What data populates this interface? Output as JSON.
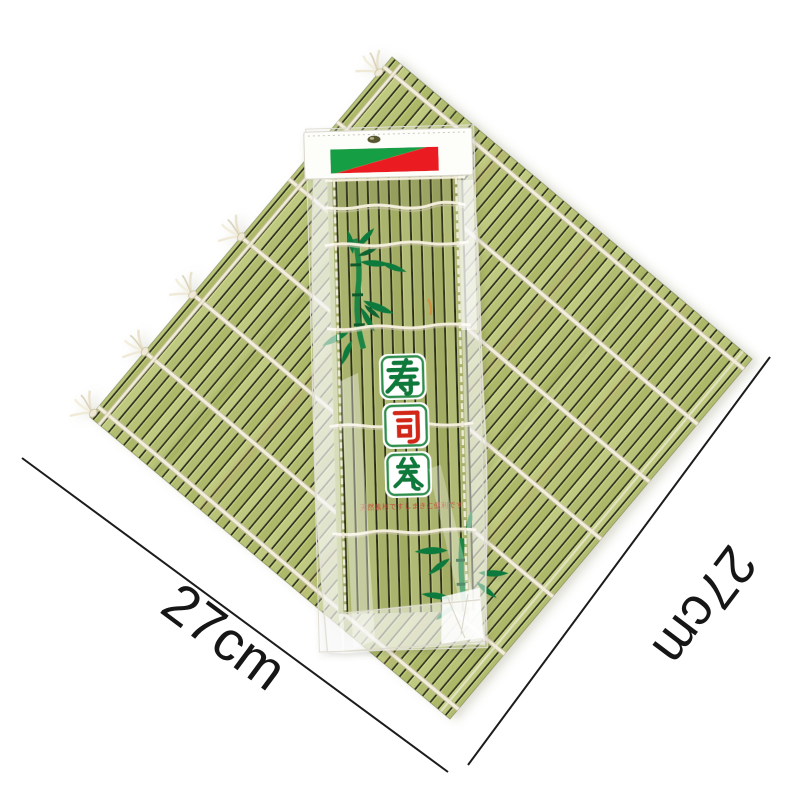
{
  "scene": {
    "description": "Bamboo sushi rolling mat displayed diagonally with a packaged sushi mat in a printed plastic sleeve on top",
    "background_color": "#ffffff"
  },
  "mat": {
    "slat_color": "#b3be72",
    "slat_gap_color": "#2f331e",
    "string_color": "#f3eedb",
    "tassel_count": 5
  },
  "package": {
    "header_card": {
      "card_color": "#fdfdfa",
      "logo_green": "#129e44",
      "logo_red": "#ea1f22",
      "hang_hole_color": "#55542f"
    },
    "mat_color": "#a9b46e",
    "title_characters": [
      {
        "char": "寿",
        "color": "#0e7a3a"
      },
      {
        "char": "司",
        "color": "#d22619"
      },
      {
        "char": "卷",
        "color": "#0e7a3a"
      }
    ],
    "tile": {
      "fill": "#ffffff",
      "border": "#2e8f4e"
    },
    "fine_print": {
      "text": "天然素材ですしまきに便利です",
      "color": "#c5453a"
    },
    "decoration": "bamboo-branch-print"
  },
  "measurements": {
    "left": {
      "label": "27cm"
    },
    "right": {
      "label": "27cm"
    },
    "line_color": "#1c1c1c",
    "text_color": "#161616"
  }
}
